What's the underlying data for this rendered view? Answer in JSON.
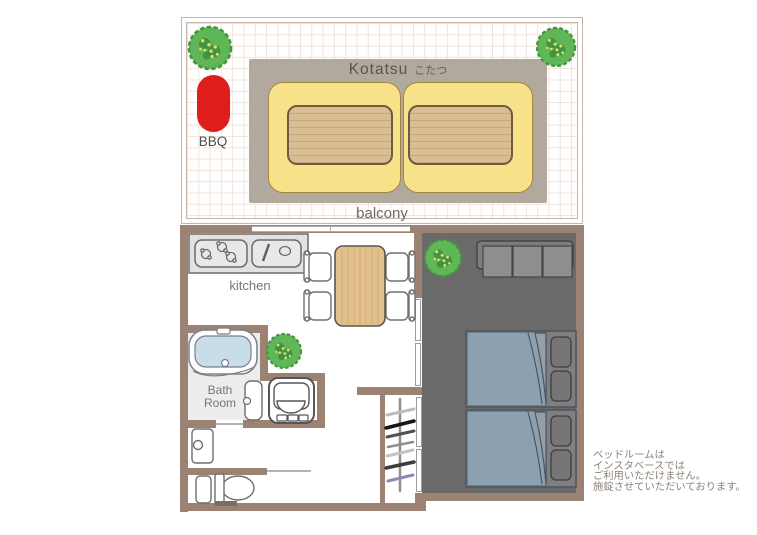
{
  "balcony": {
    "label": "balcony",
    "bbq_label": "BBQ",
    "kotatsu_label_en": "Kotatsu",
    "kotatsu_label_jp": "こたつ"
  },
  "rooms": {
    "kitchen_label": "kitchen",
    "bathroom_label": "Bath Room"
  },
  "note": {
    "line1": "ベッドルームは",
    "line2": "インスタベースでは",
    "line3": "ご利用いただけません。",
    "line4": "施錠させていただいております。"
  },
  "icons": {
    "bush-icon": "green shrub marker",
    "bbq-grill": "red BBQ grill",
    "stove-icon": "three-burner stove",
    "sink-icon": "kitchen sink",
    "dining-table-icon": "wooden dining table",
    "chair-icon": "dining chair",
    "bathtub-icon": "bathtub",
    "bathroom-door-icon": "bathroom door panel",
    "washing-machine-icon": "washing machine",
    "vanity-sink-icon": "wash basin",
    "toilet-icon": "toilet",
    "hanger-rack-icon": "clothes hanger rack",
    "sofa-icon": "three-seat sofa",
    "bed-icon": "single bed with pillows",
    "kotatsu-icon": "kotatsu table with futons"
  },
  "colors": {
    "wall": "#9c8273",
    "bedroom_floor": "#6a6a6a",
    "balcony_grid": "#f4e2da",
    "kotatsu_plate": "#b2a99e",
    "futon_yellow": "#f8e289",
    "mat_tan": "#d9bd93",
    "bbq_red": "#e01d1d",
    "bush_green": "#5fb757",
    "mattress_blue": "#8ba1b0",
    "table_wood": "#e3c18c",
    "bathtub_blue": "#c9dcea",
    "label_gray": "#767676",
    "note_gray": "#8b8379"
  }
}
